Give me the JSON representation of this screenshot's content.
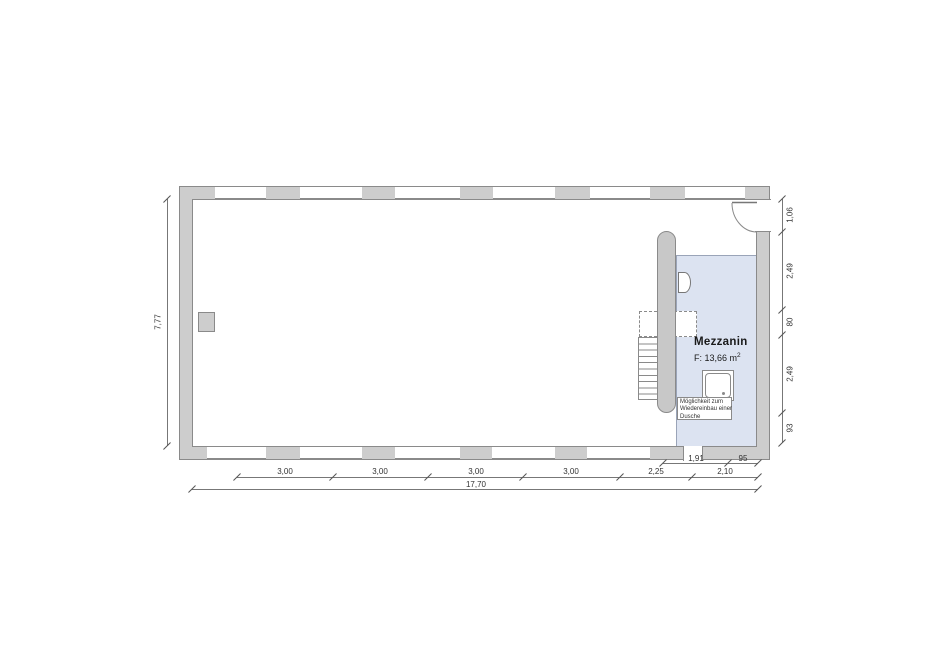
{
  "room": {
    "name": "Mezzanin",
    "area_prefix": "F:  13,66 m",
    "area_sup": "2"
  },
  "note": {
    "line1": "Möglichkeit zum",
    "line2": "Wiedereinbau einer",
    "line3": "Dusche"
  },
  "dimensions": {
    "bottom": [
      "3,00",
      "3,00",
      "3,00",
      "3,00",
      "2,25",
      "2,10"
    ],
    "bottom_sub": [
      "1,91",
      "95"
    ],
    "total_width": "17,70",
    "left_height": "7,77",
    "right": [
      "1,06",
      "2,49",
      "80",
      "2,49",
      "93"
    ]
  },
  "colors": {
    "wall": "#cdcdcd",
    "wallline": "#8a8a8a",
    "pill": "#c8c8c8",
    "mezz": "#dce3f1",
    "mezzline": "#9aa4b8",
    "dimline": "#777777",
    "tick": "#555555",
    "dimtext": "#333333",
    "ink": "#1a1a1a"
  }
}
